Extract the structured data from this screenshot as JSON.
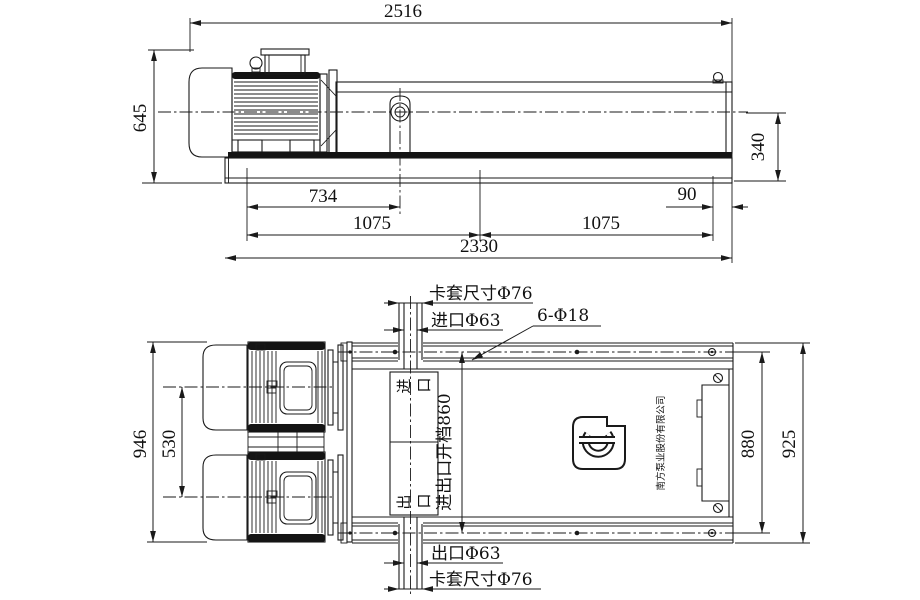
{
  "side": {
    "len_overall": "2516",
    "height_overall": "645",
    "port_height": "340",
    "d734": "734",
    "d90": "90",
    "d1075a": "1075",
    "d1075b": "1075",
    "base_len": "2330"
  },
  "plan": {
    "width_motors": "946",
    "motor_cc": "530",
    "frame_w": "880",
    "width_overall": "925",
    "ferrule_top": "卡套尺寸Φ76",
    "inlet": "进口Φ63",
    "holes": "6-Φ18",
    "outlet": "出口Φ63",
    "ferrule_bottom": "卡套尺寸Φ76",
    "port_span": "进出口开档860",
    "inlet_box": "进口",
    "outlet_box": "出口",
    "company": "南方泵业股份有限公司"
  }
}
